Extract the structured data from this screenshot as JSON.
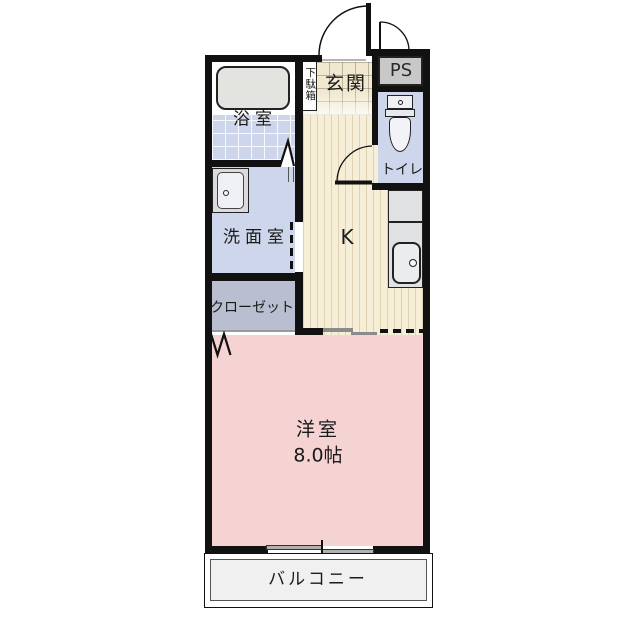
{
  "floorplan": {
    "entrance": {
      "label": "玄関"
    },
    "shoe_cabinet": {
      "label": "下駄箱"
    },
    "pipe_space": {
      "label": "PS"
    },
    "toilet": {
      "label": "トイレ"
    },
    "bathroom": {
      "label": "浴室"
    },
    "washroom": {
      "label": "洗面室"
    },
    "kitchen": {
      "label": "K"
    },
    "closet": {
      "label": "クローゼット"
    },
    "western_room": {
      "label": "洋室",
      "size": "8.0帖"
    },
    "balcony": {
      "label": "バルコニー"
    }
  },
  "colors": {
    "wall": "#111111",
    "western_room_pink": "#f5d3d3",
    "wet_room_blue": "#cdd6eb",
    "closet_gray": "#b9bed0",
    "kitchen_floor_beige": "#f6eed6",
    "entrance_tile_beige": "#f1e8cf",
    "pipe_space_gray": "#c8c8c8",
    "counter_gray": "#dfe1e3",
    "balcony_floor_gray": "#f0f0f1"
  }
}
